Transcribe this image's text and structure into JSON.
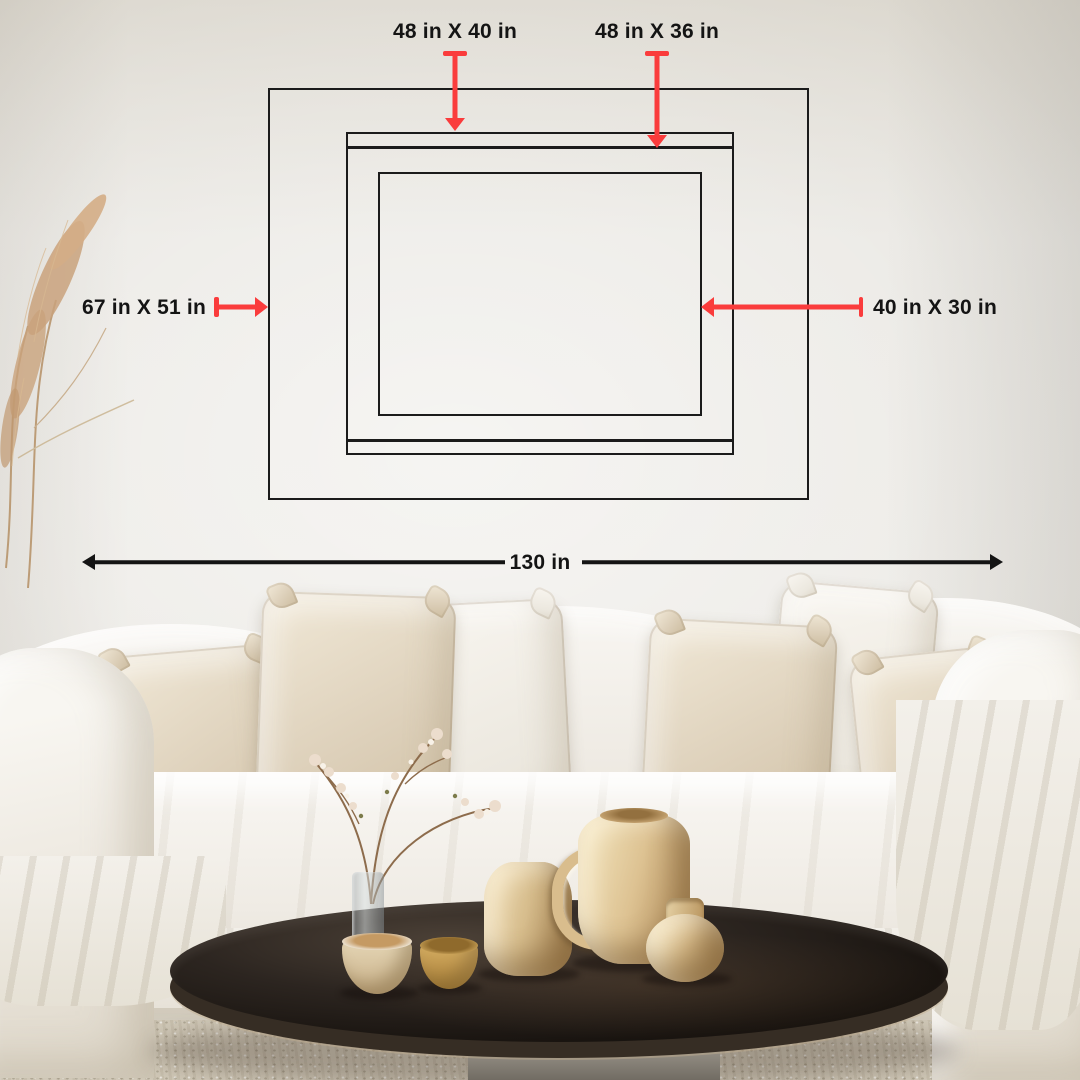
{
  "measurements": {
    "top_left": {
      "label": "48 in X 40 in"
    },
    "top_right": {
      "label": "48 in X 36 in"
    },
    "left": {
      "label": "67 in X 51 in"
    },
    "right": {
      "label": "40 in X 30 in"
    },
    "bottom_width": {
      "label": "130 in"
    }
  },
  "colors": {
    "accent_red": "#FA3C3C",
    "diagram_line": "#1B1B1B",
    "measure_arrow": "#141414"
  }
}
